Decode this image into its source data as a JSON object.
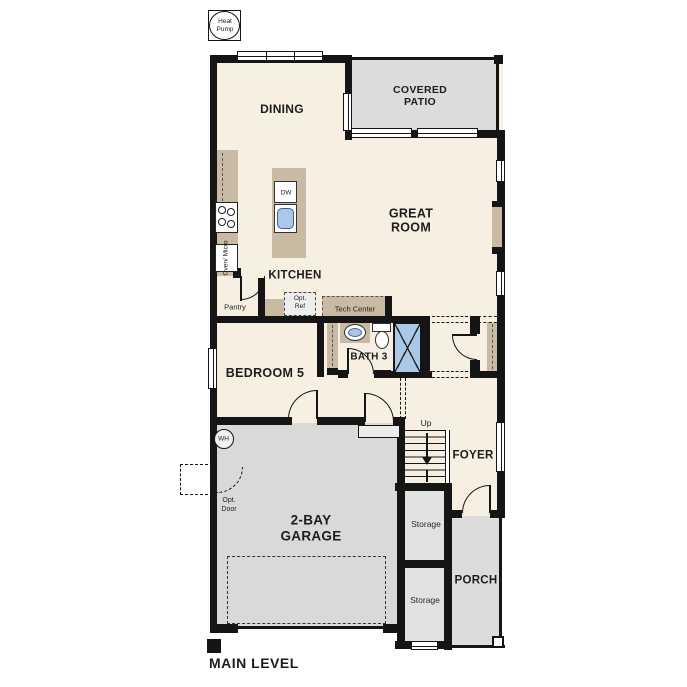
{
  "plan": {
    "heat_pump": [
      "Heat",
      "Pump"
    ],
    "rooms": {
      "dining": "DINING",
      "covered_patio": [
        "COVERED",
        "PATIO"
      ],
      "great_room": [
        "GREAT",
        "ROOM"
      ],
      "kitchen": "KITCHEN",
      "bath3": "BATH 3",
      "bedroom5": "BEDROOM 5",
      "garage": [
        "2-BAY",
        "GARAGE"
      ],
      "foyer": "FOYER",
      "porch": "PORCH"
    },
    "features": {
      "dw": "DW",
      "oven_micro": [
        "Oven/",
        "Micro"
      ],
      "pantry": "Pantry",
      "opt_ref": [
        "Opt.",
        "Ref"
      ],
      "tech_center": "Tech Center",
      "wh": "WH",
      "opt_door": [
        "Opt.",
        "Door"
      ],
      "up": "Up",
      "storage_upper": "Storage",
      "storage_lower": "Storage"
    },
    "footer": {
      "level_label": "MAIN LEVEL"
    },
    "colors": {
      "floor_cream": "#f6efe2",
      "outdoor_gray": "#dcdcdc",
      "counter_tan": "#c9baa3",
      "fixture_blue": "#aac9e9",
      "wall_black": "#151515"
    }
  }
}
